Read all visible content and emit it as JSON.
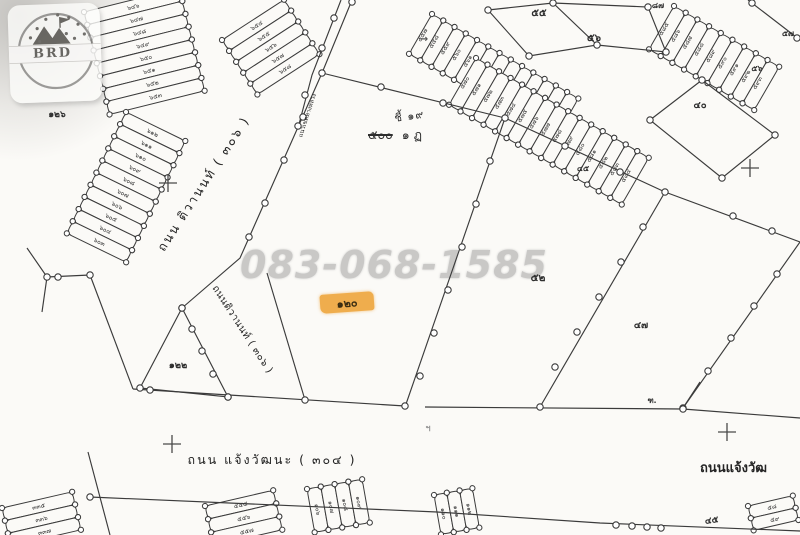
{
  "colors": {
    "ink": "#3b3b3b",
    "paper": "#fbfaf7",
    "watermark": "#c9c8c6",
    "highlight": "#efad4d"
  },
  "watermark": {
    "phone": "083-068-1585"
  },
  "logo": {
    "text": "BRD"
  },
  "highlight_plot": {
    "label": "๑๒๐"
  },
  "survey_note": {
    "line1": "ชี้ ๑๙",
    "struck": "๕๐๐",
    "rest": "๑ ฏ"
  },
  "roads": {
    "tiwanon": "ถนน ติวานนท์ ( ๓๐๖ )",
    "tiwanon_small": "ถนนติวานนท์ ( ๓๐๖ )",
    "chaengwattana": "ถนน แจ้งวัฒนะ ( ๓๐๔ )",
    "chaengwattana_right": "ถนนแจ้งวัฒ",
    "edge_note": "แนวเขตทางหลวง"
  },
  "plot_labels": [
    {
      "id": "p126",
      "text": "๑๒๖"
    },
    {
      "id": "p122",
      "text": "๑๒๒"
    },
    {
      "id": "p52",
      "text": "๕๒"
    },
    {
      "id": "p47",
      "text": "๔๗"
    },
    {
      "id": "p55",
      "text": "๕๕"
    },
    {
      "id": "p56",
      "text": "๕๖"
    },
    {
      "id": "p87",
      "text": "๘๗"
    },
    {
      "id": "p57",
      "text": "๕๗"
    },
    {
      "id": "p56b",
      "text": "๕๖"
    },
    {
      "id": "p40",
      "text": "๔๐"
    },
    {
      "id": "p45a",
      "text": "๔๕"
    },
    {
      "id": "p45b",
      "text": "๔๕"
    },
    {
      "id": "pjn",
      "text": "ฑ."
    },
    {
      "id": "ptick",
      "text": "ฯ"
    },
    {
      "id": "parrow",
      "text": "→"
    }
  ],
  "strip_bands": [
    {
      "id": "top-left-a",
      "labels": [
        "๖๔๖",
        "๖๔๗",
        "๖๔๘",
        "๖๔๙",
        "๖๕๐",
        "๖๕๑",
        "๖๕๒",
        "๖๕๓"
      ]
    },
    {
      "id": "top-left-b",
      "labels": [
        "๖๕๔",
        "๖๕๕",
        "๖๕๖",
        "๖๕๗",
        "๖๕๘"
      ]
    },
    {
      "id": "left",
      "labels": [
        "๖๑๒",
        "๖๑๑",
        "๖๑๐",
        "๖๐๙",
        "๖๐๘",
        "๖๐๗",
        "๖๐๖",
        "๖๐๕",
        "๖๐๔",
        "๖๐๓"
      ]
    },
    {
      "id": "top-center-a",
      "labels": [
        "๕๕๗",
        "๕๕๘",
        "๕๕๙",
        "๕๖๐",
        "๕๖๑",
        "๕๖๒",
        "๕๖๓",
        "๕๖๔",
        "๕๖๕",
        "๕๖๖",
        "๕๖๗",
        "๕๖๘",
        "๕๖๙"
      ]
    },
    {
      "id": "top-center-b",
      "labels": [
        "๕๗๐",
        "๕๗๑",
        "๕๗๒",
        "๕๗๓",
        "๕๗๔",
        "๕๗๕",
        "๕๗๖",
        "๕๗๗",
        "๕๗๘",
        "๕๗๙",
        "๕๘๐",
        "๕๘๑",
        "๕๘๒",
        "๕๘๓",
        "๕๘๔"
      ]
    },
    {
      "id": "top-right",
      "labels": [
        "๕๘๕",
        "๕๘๖",
        "๕๘๗",
        "๕๘๘",
        "๕๘๙",
        "๕๙๐",
        "๕๙๑",
        "๕๙๒",
        "๕๙๓"
      ]
    },
    {
      "id": "bottom-a",
      "labels": [
        "๕๕๕",
        "๕๕๖",
        "๕๕๗"
      ]
    },
    {
      "id": "bottom-b",
      "labels": [
        "๑๐๖",
        "๑๐๗",
        "๑๐๘",
        "๑๐๙"
      ]
    },
    {
      "id": "bottom-c",
      "labels": [
        "๑๑๐",
        "๑๑๑",
        "๑๑๒"
      ]
    },
    {
      "id": "bottom-right",
      "labels": [
        "๕๘",
        "๕๙"
      ]
    },
    {
      "id": "bottom-left",
      "labels": [
        "๓๓๕",
        "๓๓๖",
        "๓๓๗"
      ]
    }
  ]
}
